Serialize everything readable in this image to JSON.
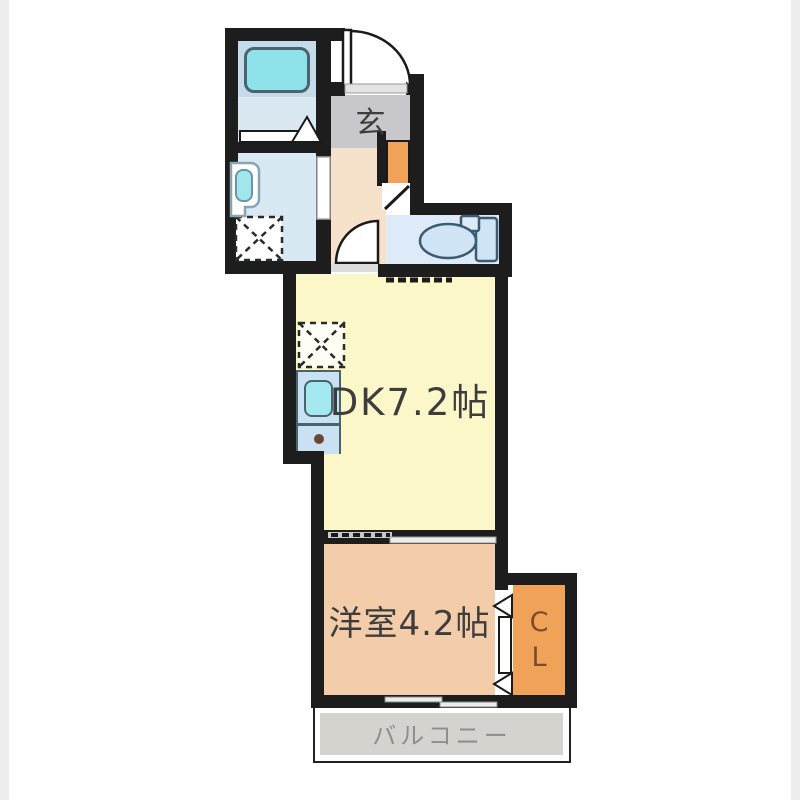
{
  "rooms": {
    "genkan": {
      "label": "玄"
    },
    "dk": {
      "label": "DK7.2帖"
    },
    "western": {
      "label": "洋室4.2帖"
    },
    "closet": {
      "letter_c": "C",
      "letter_l": "L"
    },
    "balcony": {
      "label": "バルコニー"
    }
  },
  "fixtures": [
    "bathtub",
    "washbasin",
    "washing-machine-space",
    "toilet",
    "shoe-cabinet",
    "kitchen-sink",
    "stove",
    "refrigerator-space"
  ],
  "colors": {
    "wall": "#1d1d1d",
    "bathroom_floor": "#dae8f1",
    "bathtub": "#90e2ea",
    "washroom": "#d8e9f4",
    "genkan": "#c8c8cc",
    "hallway": "#f6e2ca",
    "toilet_room": "#dcebf7",
    "dk": "#fbf7c8",
    "western_room": "#f3cda9",
    "closet": "#efa258",
    "shoe_cabinet": "#efa258",
    "balcony": "#d6d3ce",
    "fixture_blue": "#c9e1f2",
    "sink_cyan": "#a5e8ef",
    "label_dark": "#3d3d3d",
    "closet_text": "#7c4b2a",
    "balcony_text": "#8f8f8f"
  }
}
